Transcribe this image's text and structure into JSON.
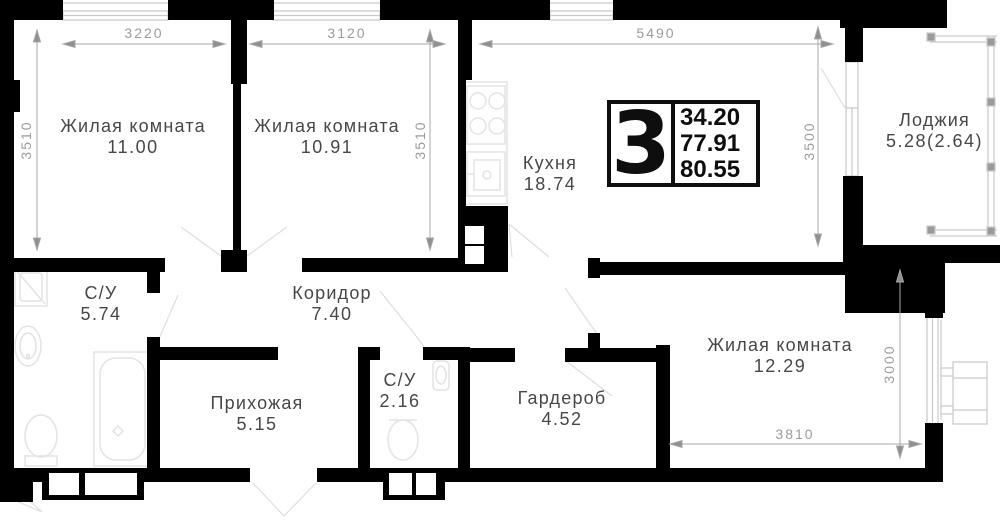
{
  "title": "3-room apartment floor plan",
  "badge": {
    "number": "3",
    "areas": [
      "34.20",
      "77.91",
      "80.55"
    ]
  },
  "rooms": {
    "room1": {
      "label": "Жилая комната",
      "area": "11.00"
    },
    "room2": {
      "label": "Жилая комната",
      "area": "10.91"
    },
    "kitchen": {
      "label": "Кухня",
      "area": "18.74"
    },
    "loggia": {
      "label": "Лоджия",
      "area": "5.28(2.64)"
    },
    "bathroom": {
      "label": "С/У",
      "area": "5.74"
    },
    "corridor": {
      "label": "Коридор",
      "area": "7.40"
    },
    "hallway": {
      "label": "Прихожая",
      "area": "5.15"
    },
    "wc": {
      "label": "С/У",
      "area": "2.16"
    },
    "wardrobe": {
      "label": "Гардероб",
      "area": "4.52"
    },
    "room3": {
      "label": "Жилая комната",
      "area": "12.29"
    }
  },
  "dimensions": {
    "top_room1": "3220",
    "top_room2": "3120",
    "top_kitchen": "5490",
    "left_room1": "3510",
    "right_room2": "3510",
    "kitchen_right": "3500",
    "room3_right": "3000",
    "room3_bottom": "3810"
  },
  "colors": {
    "wall": "#000000",
    "dimension": "#9b9b9b",
    "label": "#474747",
    "fixture": "#e3e3e3",
    "background": "#ffffff"
  }
}
